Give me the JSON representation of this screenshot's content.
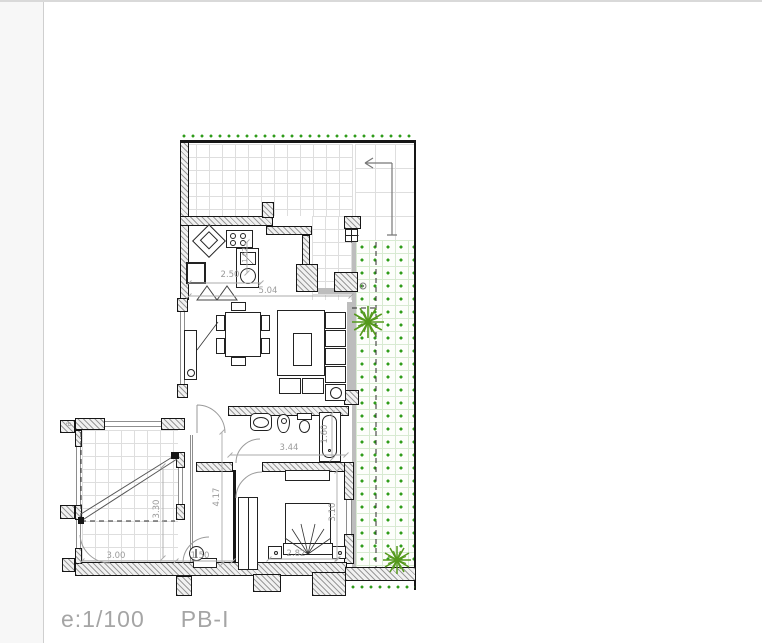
{
  "footer": {
    "scale": "e:1/100",
    "plan_name": "PB-I"
  },
  "plan": {
    "dimensions": {
      "kitchen_width": "2.50",
      "living_width": "5.04",
      "kitchen_counter": "1.62",
      "bath_width": "3.44",
      "bathtub_length": "1.60",
      "hall_length": "4.17",
      "bedroom_depth": "3.10",
      "bed_width": "2.82",
      "patio_width": "3.00",
      "patio_depth": "3.30",
      "wc_width": "1.50",
      "edge_marker": "B"
    },
    "colors": {
      "vegetation_green": "#2f9c1a",
      "tree_green": "#55991c",
      "dimension_gray": "#9b9b9b",
      "wall_black": "#161616",
      "tile_line_gray": "#dedede",
      "garden_grid_green": "#d8ead2",
      "viewer_margin_gray": "#f7f7f7"
    }
  }
}
